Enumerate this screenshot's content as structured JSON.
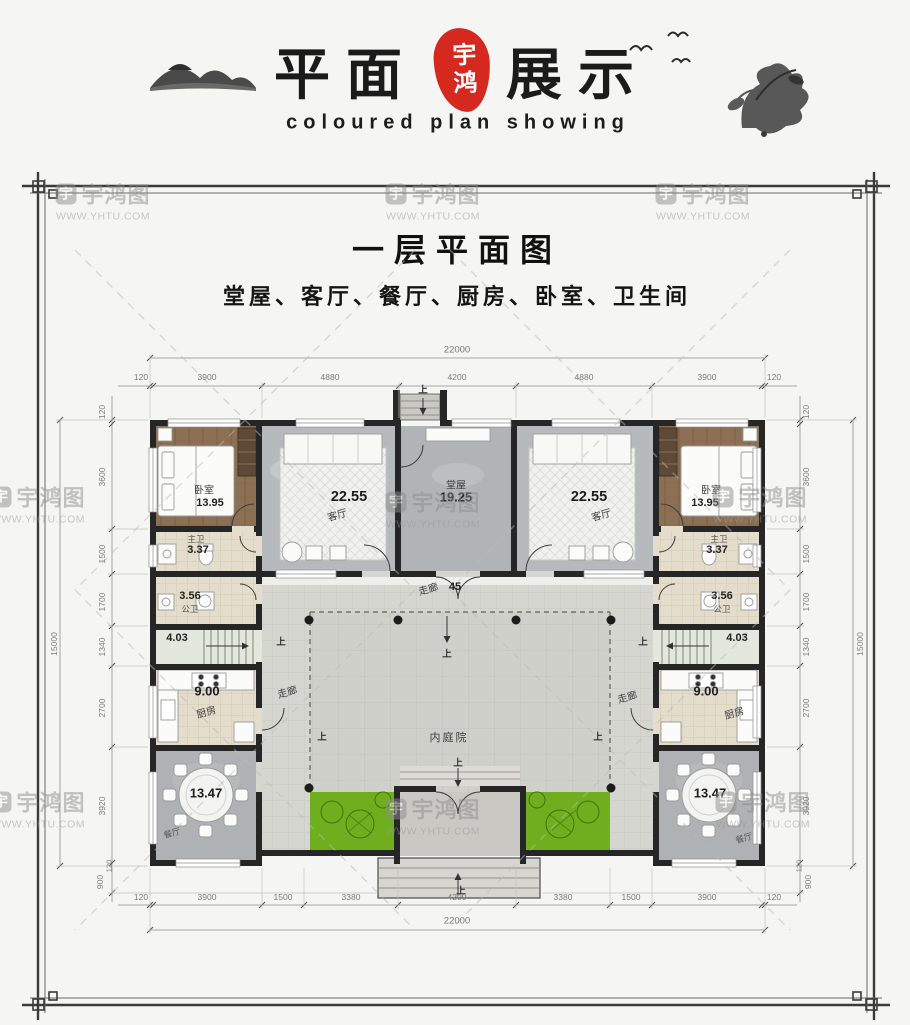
{
  "header": {
    "title_left": "平面",
    "title_right": "展示",
    "seal": "宇鸿",
    "subtitle": "coloured plan showing"
  },
  "watermark": {
    "icon": "宇",
    "brand": "宇鸿图",
    "url": "WWW.YHTU.COM"
  },
  "sheet": {
    "title": "一层平面图",
    "subtitle": "堂屋、客厅、餐厅、厨房、卧室、卫生间"
  },
  "rooms": {
    "hall": {
      "name": "堂屋",
      "area": "19.25"
    },
    "living": {
      "name": "客厅",
      "area": "22.55"
    },
    "bedroom": {
      "name": "卧室",
      "area": "13.95"
    },
    "bath_master": {
      "name": "主卫",
      "area": "3.37"
    },
    "bath_public": {
      "name": "公卫",
      "area": "3.56"
    },
    "stairs": {
      "area": "4.03"
    },
    "kitchen": {
      "name": "厨房",
      "area": "9.00"
    },
    "dining": {
      "name": "餐厅",
      "area": "13.47"
    },
    "corridor": {
      "name": "走廊",
      "area": "45"
    },
    "courtyard": {
      "name": "内庭院"
    },
    "up": "上"
  },
  "dims": {
    "top_total": "22000",
    "bottom_total": "22000",
    "side_total": "15000",
    "top": [
      "120",
      "3900",
      "4880",
      "4200",
      "4880",
      "3900",
      "120"
    ],
    "bottom": [
      "120",
      "3900",
      "1500",
      "3380",
      "4200",
      "3380",
      "1500",
      "3900",
      "120"
    ],
    "left": [
      "120",
      "3600",
      "1500",
      "1700",
      "1340",
      "2700",
      "3920",
      "120",
      "900"
    ],
    "right": [
      "120",
      "3600",
      "1500",
      "1700",
      "1340",
      "2700",
      "3920",
      "120",
      "900"
    ]
  },
  "colors": {
    "accent_seal": "#d5281e",
    "wall": "#262626",
    "green": "#6fae1e"
  }
}
